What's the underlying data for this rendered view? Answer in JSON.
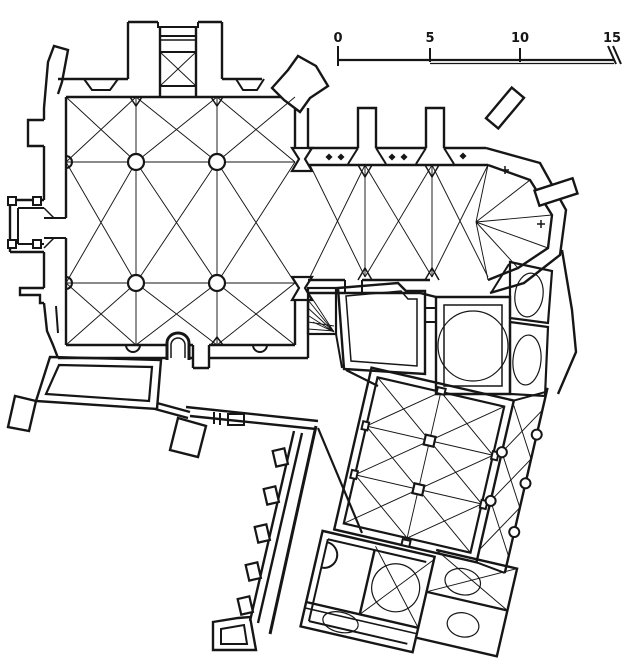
{
  "figure": {
    "kind": "architectural floor plan",
    "subject": "ground plan of a church with bell tower, choir apse and adjoining monastic buildings",
    "ink_color": "#161616",
    "paper_color": "#ffffff"
  },
  "scale_bar": {
    "labels": [
      "0",
      "5",
      "10",
      "15"
    ]
  }
}
